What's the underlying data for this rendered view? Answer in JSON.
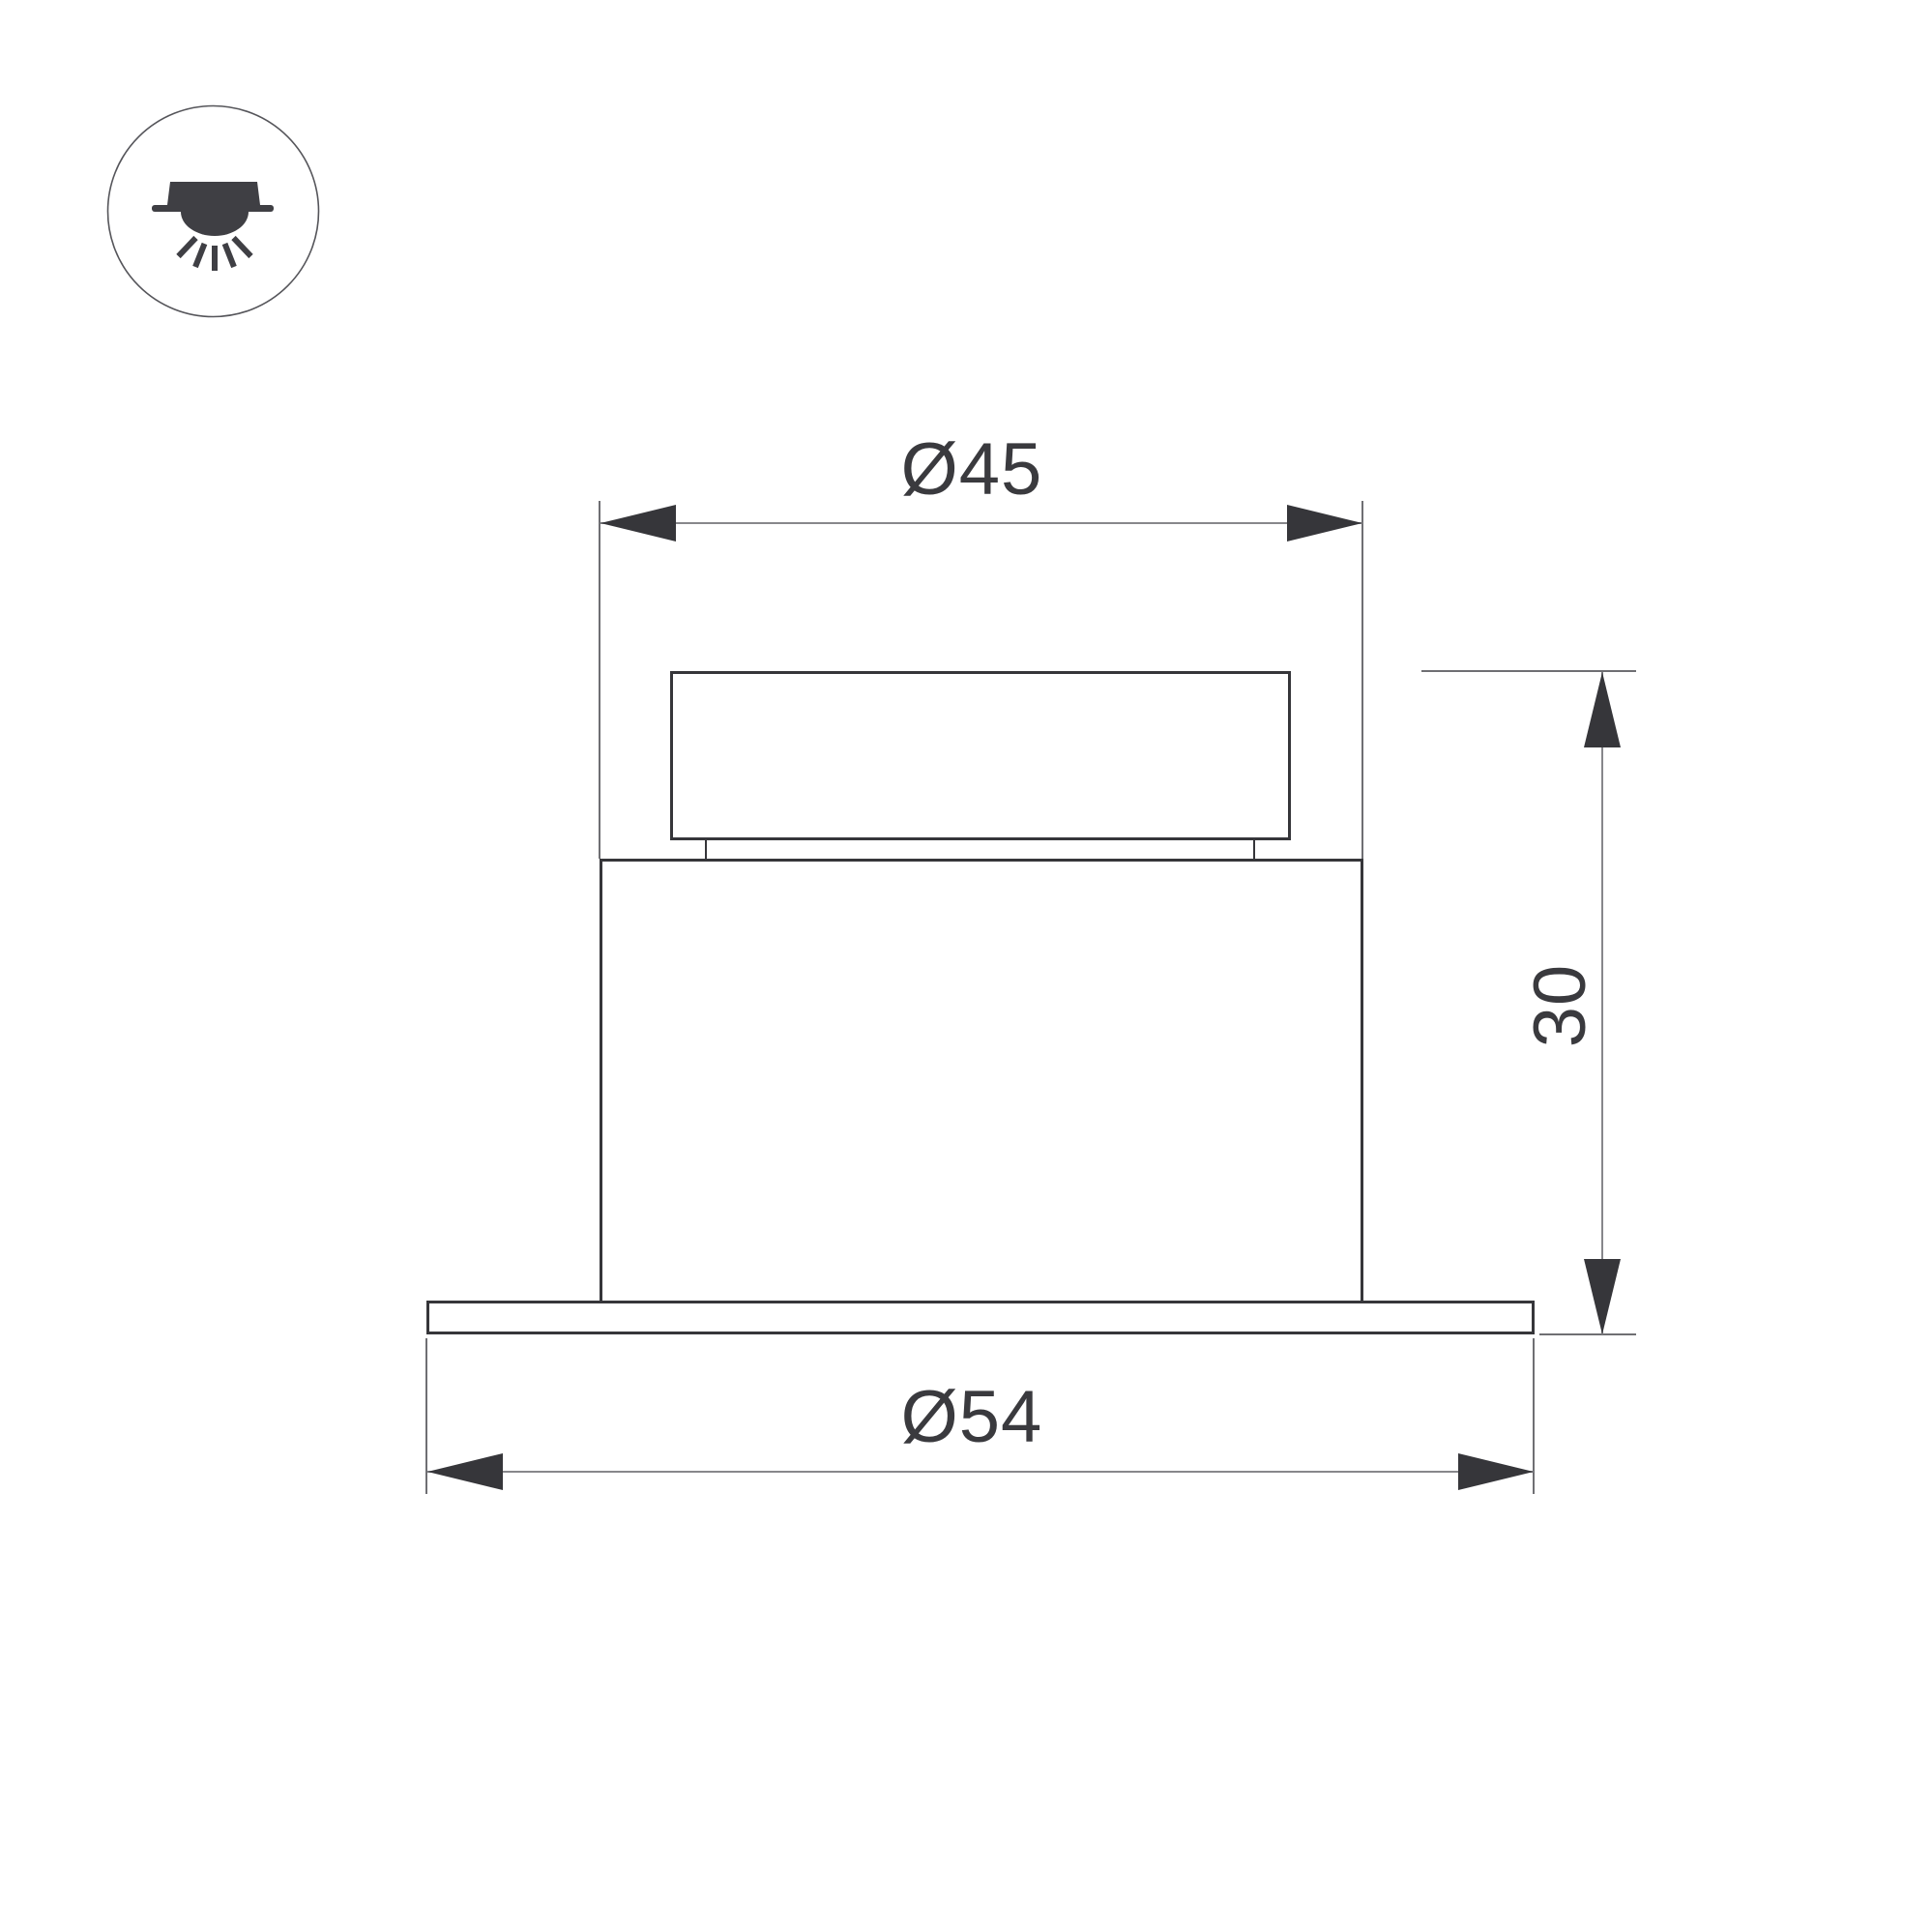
{
  "title": "Recessed downlight dimensional drawing",
  "labels": {
    "top_diameter": "Ø45",
    "bottom_diameter": "Ø54",
    "height": "30"
  },
  "dimensions_mm": {
    "top_diameter": 45,
    "bottom_diameter": 54,
    "height": 30
  },
  "icon": {
    "name": "recessed-downlight-icon",
    "meaning": "ceiling-recessed luminaire shining downward"
  },
  "colors": {
    "background": "#ffffff",
    "object_line": "#36363a",
    "dimension_line": "#87878b",
    "extension_line": "#6f6f73",
    "text": "#3a3a3e"
  }
}
